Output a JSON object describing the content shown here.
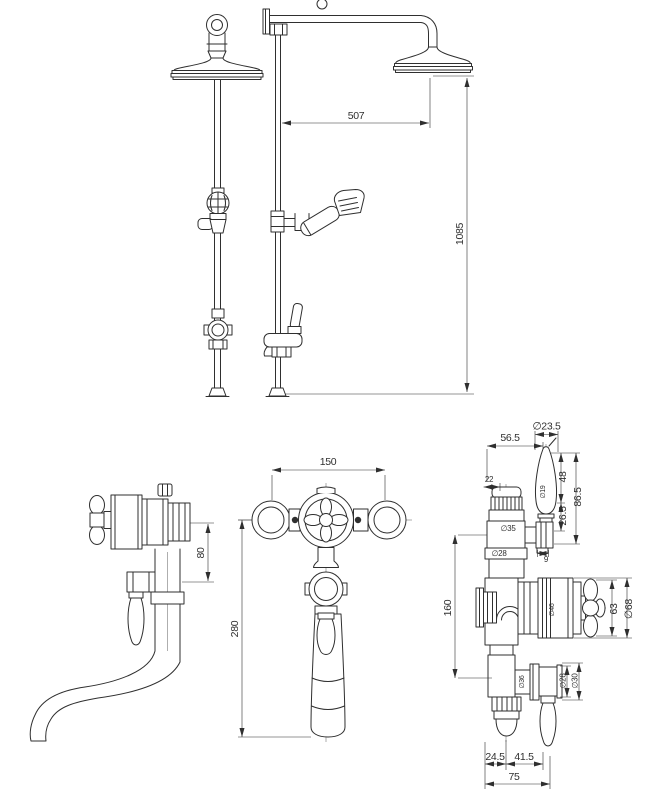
{
  "drawing": {
    "background": "#ffffff",
    "line_color": "#2f2f2f",
    "views": {
      "shower_column": {
        "title": "shower column side and front elevation",
        "dims": {
          "arm_projection": "507",
          "riser_height": "1085"
        }
      },
      "bath_filler_side": {
        "title": "bath filler side elevation",
        "dims": {
          "outlet_drop": "80"
        }
      },
      "bath_filler_front": {
        "title": "bath filler front elevation",
        "dims": {
          "valve_centres": "150",
          "overall_height": "280"
        }
      },
      "valve_detail": {
        "title": "thermostatic valve detail",
        "dims": {
          "lever_offset": "56.5",
          "lever_knob_dia": "∅23.5",
          "cap_flat": "22",
          "lever_shaft_dia": "∅19",
          "lever_upper_len": "48",
          "lever_total": "86.5",
          "lever_lower_len": "26.5",
          "upper_body_dia": "∅35",
          "upper_neck_dia": "∅28",
          "stem_flat": "9",
          "body_height": "160",
          "collar_dia": "∅46",
          "handle_span": "63",
          "cartridge_dia": "∅68",
          "lower_body_dia": "∅36",
          "outlet_neck_dia": "∅28",
          "outlet_boss_dia": "∅30",
          "base_offset_a": "24.5",
          "base_offset_b": "41.5",
          "base_width": "75"
        }
      }
    }
  }
}
